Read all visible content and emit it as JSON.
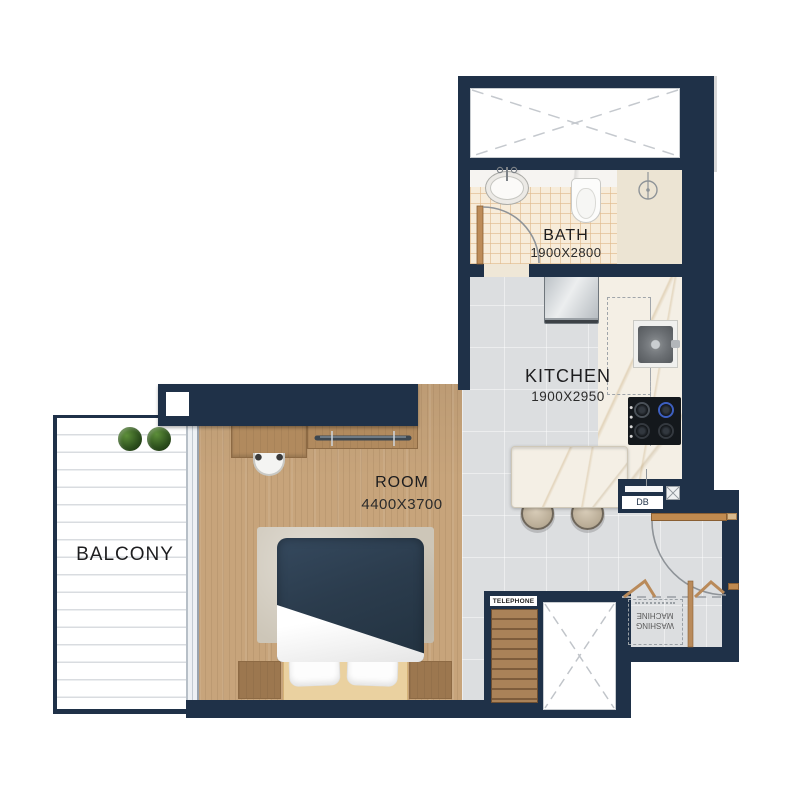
{
  "rooms": {
    "bath": {
      "label": "BATH",
      "dimensions": "1900X2800"
    },
    "kitchen": {
      "label": "KITCHEN",
      "dimensions": "1900X2950"
    },
    "room": {
      "label": "ROOM",
      "dimensions": "4400X3700"
    },
    "balcony": {
      "label": "BALCONY"
    }
  },
  "annotations": {
    "telephone": "TELEPHONE",
    "db": "DB",
    "washing_machine": "WASHING MACHINE"
  },
  "fixtures": [
    "bed",
    "rug",
    "pillows",
    "nightstands",
    "desk",
    "chair",
    "wardrobe",
    "washbasin",
    "toilet",
    "shower-drain",
    "bath-door",
    "fridge",
    "kitchen-sink",
    "hob",
    "island-counter",
    "stools",
    "entry-door",
    "bifold-doors",
    "washing-machine",
    "telephone-cabinet",
    "shafts",
    "plants"
  ],
  "colors": {
    "wall": "#1f3148",
    "wood_floor": "#c7a47b",
    "furniture_wood": "#b18a5e",
    "kitchen_floor": "#dcdee0",
    "bath_tile": "#f7ecda",
    "marble": "#f4efe5",
    "duvet": "#2e3f4f",
    "door_wood": "#bd8c59",
    "line_art": "#8e9398",
    "plant": "#3c6426"
  }
}
